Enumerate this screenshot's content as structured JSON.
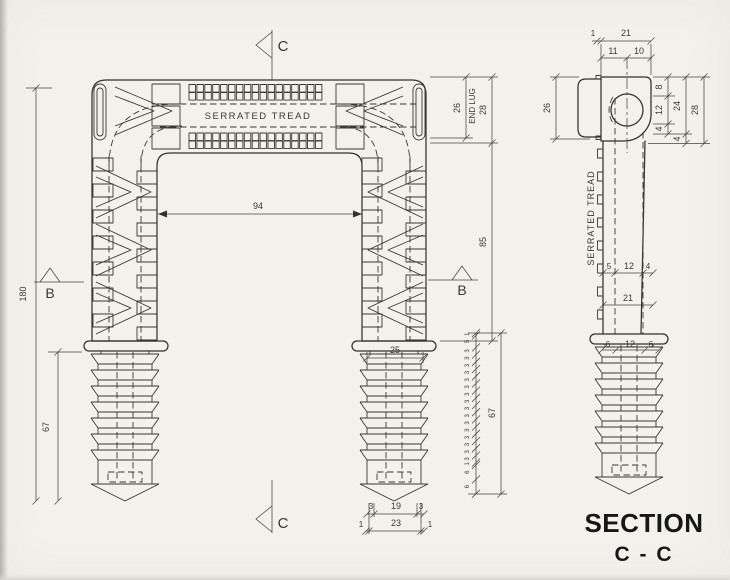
{
  "front": {
    "tread_label": "SERRATED TREAD",
    "dim_overall_height": "180",
    "dim_anchor_length": "67",
    "dim_inner_width": "94",
    "dim_anchor_width": "25",
    "dim_tip_width": "19",
    "dim_tip_outer_width": "23",
    "dim_tip_chamfer": "3",
    "dim_tip_edge": "1",
    "dim_end_lug_height": "26",
    "end_lug_label": "END LUG",
    "dim_head_height": "28",
    "dim_leg_length": "85",
    "marker_b": "B",
    "marker_c": "C"
  },
  "pitch_detail": {
    "segments": [
      "1",
      "5",
      "3",
      "3",
      "3",
      "3",
      "3",
      "3",
      "3",
      "3",
      "3",
      "3",
      "3",
      "3",
      "3",
      "3",
      "3",
      "3",
      "1",
      "6",
      "6"
    ],
    "dim_total": "67"
  },
  "section": {
    "dim_top_edge": "1",
    "dim_top_width": "21",
    "dim_top_left": "11",
    "dim_top_right": "10",
    "dim_head_depth": "26",
    "dim_right_top": "8",
    "dim_right_mid": "12",
    "dim_right_bottom": "4",
    "dim_right_span": "24",
    "dim_right_lower": "4",
    "dim_right_total": "28",
    "tread_label": "SERRATED TREAD",
    "dim_leg_left": "5",
    "dim_leg_mid": "12",
    "dim_leg_right": "4",
    "dim_leg_width": "21",
    "dim_anchor_left": "6",
    "dim_anchor_mid": "12",
    "dim_anchor_right": "6"
  },
  "title": {
    "line1": "SECTION",
    "line2": "C - C"
  },
  "colors": {
    "paper": "#f3f1ec",
    "line": "#33312e",
    "text": "#3a3832",
    "title": "#171717"
  }
}
